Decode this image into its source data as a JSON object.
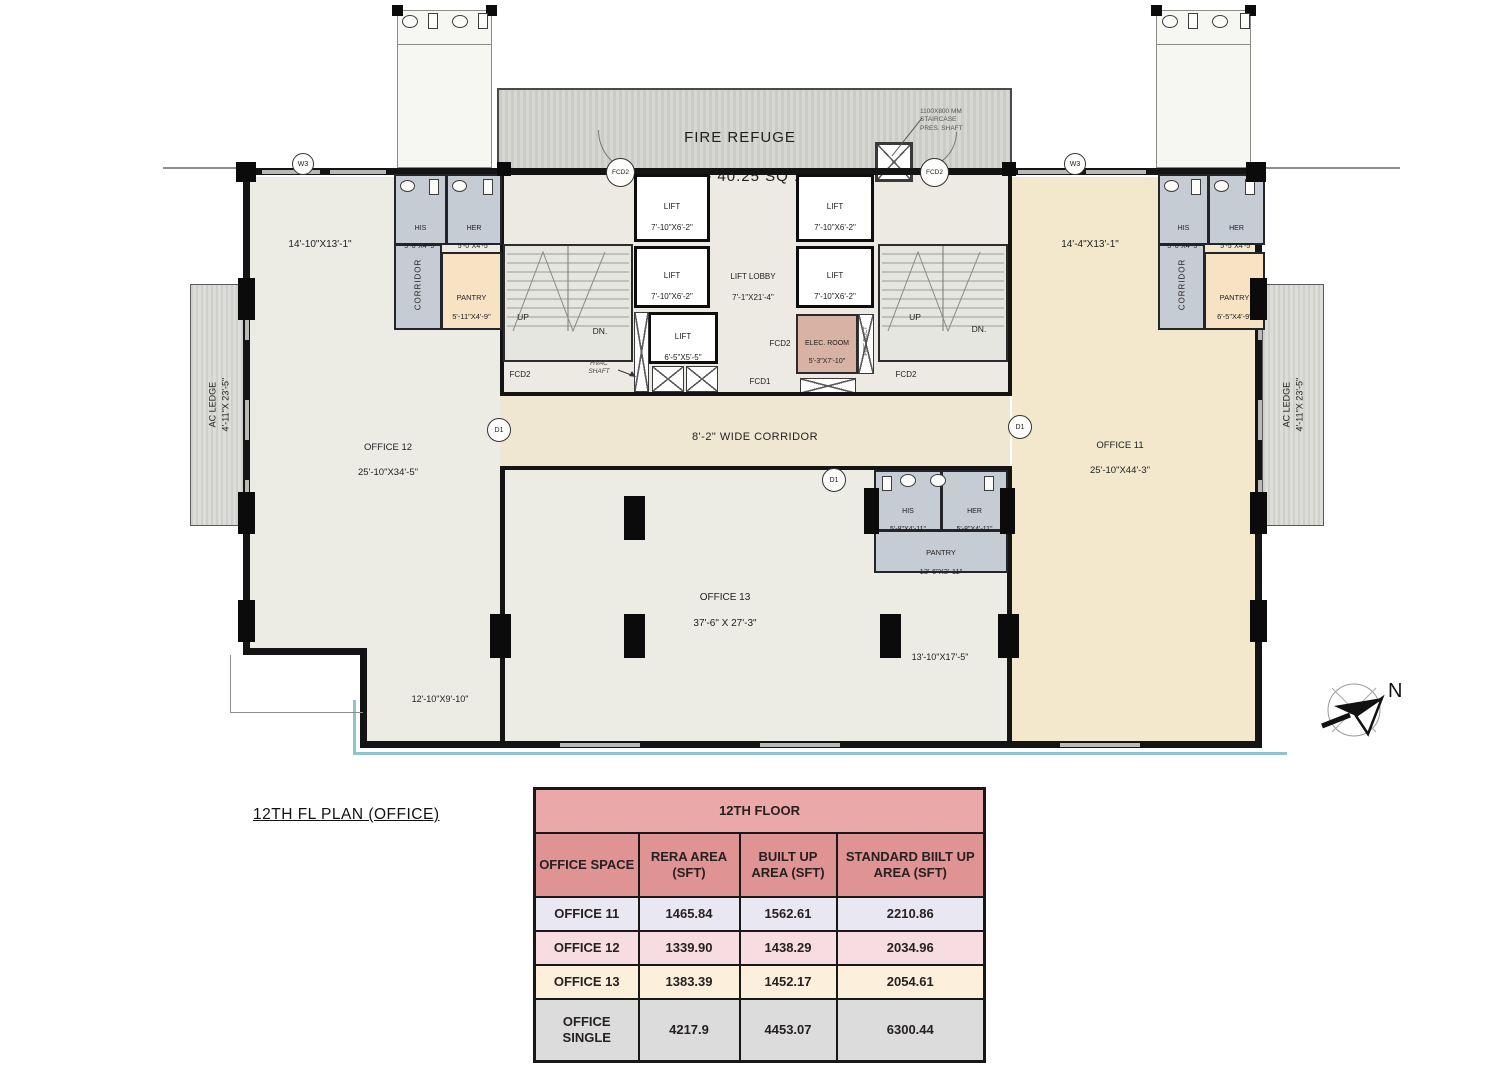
{
  "plan_title": "12TH FL PLAN (OFFICE)",
  "compass_label": "N",
  "fire_refuge": {
    "title": "FIRE REFUGE",
    "area": "AREA - 40.25  SQ .M ."
  },
  "notes": {
    "staircase_shaft": "1100X800 MM\nSTAIRCASE\nPRES. SHAFT",
    "hvac_shaft": "HVAC\nSHAFT",
    "fire_duct": "FIRE DUCT",
    "corridor": "8'-2\" WIDE CORRIDOR",
    "up": "UP",
    "dn": "DN.",
    "fcd1": "FCD1",
    "fcd2": "FCD2",
    "w3": "W3",
    "d1": "D1"
  },
  "offices": {
    "o11": {
      "name": "OFFICE 11",
      "dims": "25'-10\"X44'-3\"",
      "upper_dim": "14'-4\"X13'-1\""
    },
    "o12": {
      "name": "OFFICE 12",
      "dims": "25'-10\"X34'-5\"",
      "upper_dim": "14'-10\"X13'-1\"",
      "lower_dim": "12'-10\"X9'-10\""
    },
    "o13": {
      "name": "OFFICE 13",
      "dims": "37'-6\" X 27'-3\"",
      "side_dim": "13'-10\"X17'-5\""
    }
  },
  "rooms": {
    "ac_ledge": {
      "name": "AC LEDGE",
      "dims": "4'-11\"X 23'-5\""
    },
    "left_his": {
      "name": "HIS",
      "dims": "5'-0\"X4'-5\""
    },
    "left_her": {
      "name": "HER",
      "dims": "5'-0\"X4'-5\""
    },
    "left_corridor": {
      "name": "CORRIDOR"
    },
    "left_pantry": {
      "name": "PANTRY",
      "dims": "5'-11\"X4'-9\""
    },
    "right_his": {
      "name": "HIS",
      "dims": "5'-0\"X4'-5\""
    },
    "right_her": {
      "name": "HER",
      "dims": "5'-5\"X4'-5\""
    },
    "right_corridor": {
      "name": "CORRIDOR"
    },
    "right_pantry": {
      "name": "PANTRY",
      "dims": "6'-5\"X4'-9\""
    },
    "mid_his": {
      "name": "HIS",
      "dims": "5'-8\"X4'-11\""
    },
    "mid_her": {
      "name": "HER",
      "dims": "5'-8\"X4'-11\""
    },
    "mid_pantry": {
      "name": "PANTRY",
      "dims": "13'-6\"X3'-11\""
    },
    "lift": {
      "name": "LIFT",
      "dims": "7'-10\"X6'-2\""
    },
    "lift_small": {
      "name": "LIFT",
      "dims": "6'-5\"X5'-5\""
    },
    "lift_lobby": {
      "name": "LIFT LOBBY",
      "dims": "7'-1\"X21'-4\""
    },
    "elec_room": {
      "name": "ELEC. ROOM",
      "dims": "5'-3\"X7'-10\""
    }
  },
  "table": {
    "title": "12TH FLOOR",
    "columns": [
      "OFFICE SPACE",
      "RERA AREA (SFT)",
      "BUILT UP AREA (SFT)",
      "STANDARD BIILT UP AREA (SFT)"
    ],
    "rows": [
      {
        "name": "OFFICE 11",
        "rera": "1465.84",
        "built": "1562.61",
        "standard": "2210.86"
      },
      {
        "name": "OFFICE 12",
        "rera": "1339.90",
        "built": "1438.29",
        "standard": "2034.96"
      },
      {
        "name": "OFFICE 13",
        "rera": "1383.39",
        "built": "1452.17",
        "standard": "2054.61"
      },
      {
        "name": "OFFICE SINGLE",
        "rera": "4217.9",
        "built": "4453.07",
        "standard": "6300.44"
      }
    ]
  },
  "colors": {
    "table_title_bg": "#eba8a8",
    "table_header_bg": "#e09393",
    "row_office11_bg": "#e9e7f1",
    "row_office12_bg": "#f7dce2",
    "row_office13_bg": "#fcf0dd",
    "row_single_bg": "#dcdcdc",
    "office11_floor": "#f3e8cb",
    "office12_floor": "#ecebe4",
    "wet_area": "#c6ccd4",
    "pantry": "#f7e3c4",
    "elec_room": "#d8b3a3",
    "refuge_gray": "#cccccb",
    "water_line": "#8fc3cf"
  }
}
